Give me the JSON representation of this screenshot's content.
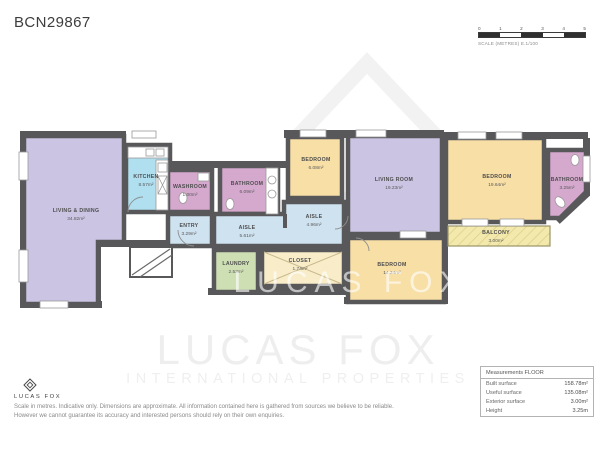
{
  "title": "BCN29867",
  "scale_bar": {
    "ticks": [
      "0",
      "1",
      "2",
      "3",
      "4",
      "5"
    ],
    "label": "SCALE (METRES) E.1/100"
  },
  "watermark": {
    "brand": "LUCAS FOX",
    "tagline": "INTERNATIONAL PROPERTIES"
  },
  "footer": {
    "logo_text": "LUCAS FOX",
    "disclaimer_line1": "Scale in metres. Indicative only. Dimensions are approximate. All information contained here is gathered from sources we believe to be reliable.",
    "disclaimer_line2": "However we cannot guarantee its accuracy and interested persons should rely on their own enquiries."
  },
  "rooms": [
    {
      "name": "LIVING & DINING",
      "area": "34.82m²"
    },
    {
      "name": "KITCHEN",
      "area": "8.57m²"
    },
    {
      "name": "WASHROOM",
      "area": "1.00m²"
    },
    {
      "name": "BATHROOM",
      "area": "6.09m²"
    },
    {
      "name": "ENTRY",
      "area": "3.29m²"
    },
    {
      "name": "AISLE",
      "area": "5.61m²"
    },
    {
      "name": "LAUNDRY",
      "area": "2.53m²"
    },
    {
      "name": "CLOSET",
      "area": "1.74m²"
    },
    {
      "name": "BEDROOM",
      "area": "6.08m²"
    },
    {
      "name": "AISLE",
      "area": "4.96m²"
    },
    {
      "name": "LIVING ROOM",
      "area": "19.23m²"
    },
    {
      "name": "BEDROOM",
      "area": "14.24m²"
    },
    {
      "name": "BEDROOM",
      "area": "19.64m²"
    },
    {
      "name": "BATHROOM",
      "area": "3.25m²"
    },
    {
      "name": "BALCONY",
      "area": "3.00m²"
    }
  ],
  "measurements": {
    "header": "Measurements FLOOR",
    "rows": [
      {
        "label": "Built surface",
        "value": "158.78m²"
      },
      {
        "label": "Useful surface",
        "value": "135.08m²"
      },
      {
        "label": "Exterior surface",
        "value": "3.00m²"
      },
      {
        "label": "Height",
        "value": "3.25m"
      }
    ]
  },
  "colors": {
    "wall": "#58585b",
    "living": "#cbc4e3",
    "bedroom": "#f8dfa6",
    "bathroom": "#d5a8ce",
    "circulation": "#cfe2f0",
    "kitchen": "#b0dff0",
    "laundry": "#cfdfb4",
    "closet": "#f8ecc9",
    "balcony": "#f3e9ac"
  }
}
